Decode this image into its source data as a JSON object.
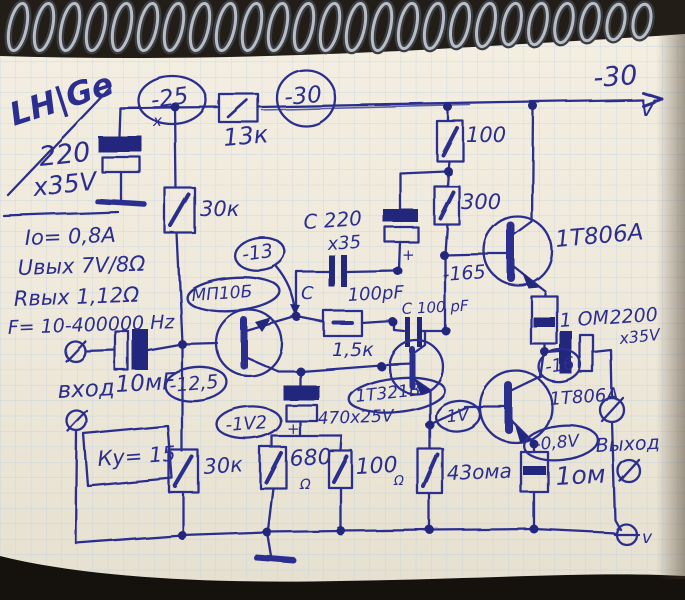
{
  "meta": {
    "description": "Hand-drawn amplifier circuit schematic in blue ink on spiral-notebook graph paper",
    "colors": {
      "ink": "#2b2e8e",
      "paper": "#efe9db",
      "grid": "#b7cce4",
      "binding_metal": "#b9bdc4"
    }
  },
  "labels": {
    "lhge": "LH|Ge",
    "cap220_value": "220",
    "cap220_voltage": "х35V",
    "v25": "-25",
    "x_mark": "х",
    "r13k": "13к",
    "v30_circle": "-30",
    "rail_voltage": "-30",
    "rail_unit": "V",
    "spec_current": "Iо= 0,8A",
    "spec_uout": "Uвых 7V/8Ω",
    "spec_rout": "Rвых 1,12Ω",
    "spec_freq": "F= 10-400000 Hz",
    "input_label": "вход",
    "input_cap": "10мF",
    "v12_5": "-12,5",
    "gain": "Ку= 15",
    "r30k_upper": "30к",
    "r30k_lower": "30к",
    "q1": "МП10Б",
    "v13": "-13",
    "capA": "С 220",
    "capA_v": "х35",
    "capB_c": "С",
    "capB_val": "100pF",
    "capC": "С 100 pF",
    "r1k5": "1,5к",
    "q2": "1Т321В",
    "cap470": "470х25V",
    "plus": "+",
    "r680": "680",
    "ohm": "Ω",
    "r100_emitter": "100",
    "r43": "43ома",
    "v1": "-1V",
    "v1v2": "-1V2",
    "r100_top": "100",
    "r300": "300",
    "v165": "-165",
    "q3": "1Т806А",
    "r1om_upper": "1 ОМ",
    "cap2200": "2200",
    "cap2200_v": "х35V",
    "v16": "-16",
    "q4": "1Т806А",
    "v0_8": "-0,8V",
    "output": "Выход",
    "r1om_lower": "1ом",
    "minus_terminal": "v"
  }
}
